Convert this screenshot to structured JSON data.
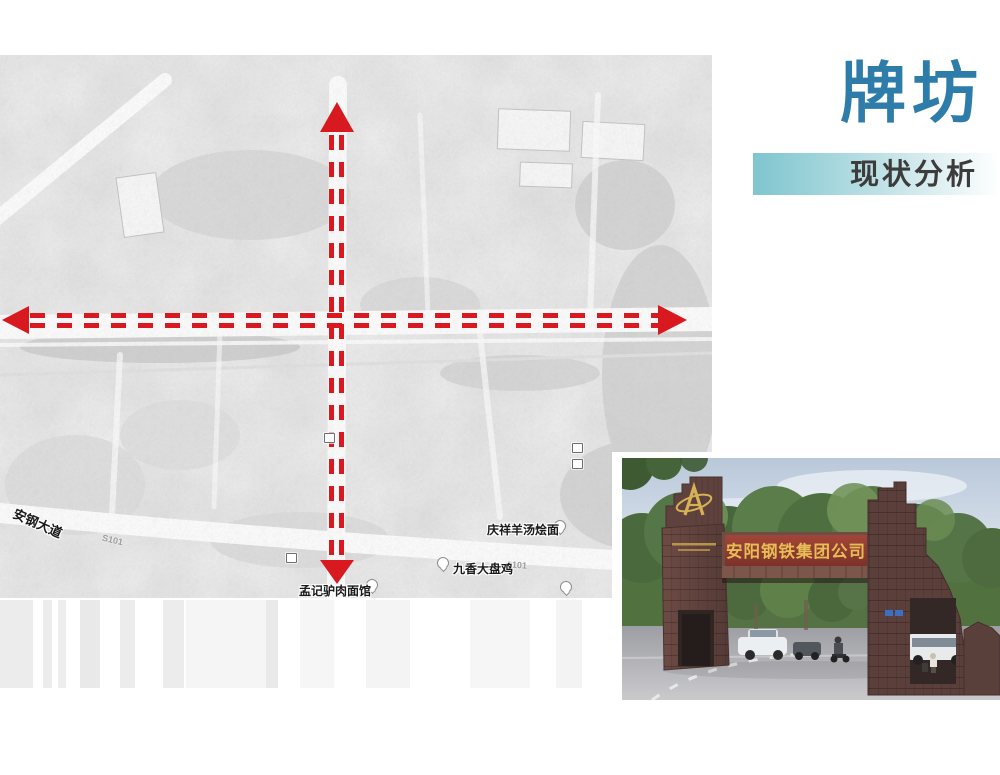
{
  "slide": {
    "title": "牌坊",
    "subtitle": "现状分析"
  },
  "map": {
    "labels": [
      {
        "text": "安钢大道",
        "type": "road"
      },
      {
        "text": "S101",
        "type": "route"
      },
      {
        "text": "S101",
        "type": "route"
      },
      {
        "text": "庆祥羊汤烩面",
        "type": "poi"
      },
      {
        "text": "九香大盘鸡",
        "type": "poi"
      },
      {
        "text": "孟记驴肉面馆",
        "type": "poi"
      }
    ],
    "axis_color": "#d8191f"
  },
  "photo": {
    "sign_text": "安阳钢铁集团公司"
  },
  "colors": {
    "title_blue": "#2d7ca9",
    "band_teal": "#7fc5cf",
    "arrow_red": "#d8191f"
  }
}
